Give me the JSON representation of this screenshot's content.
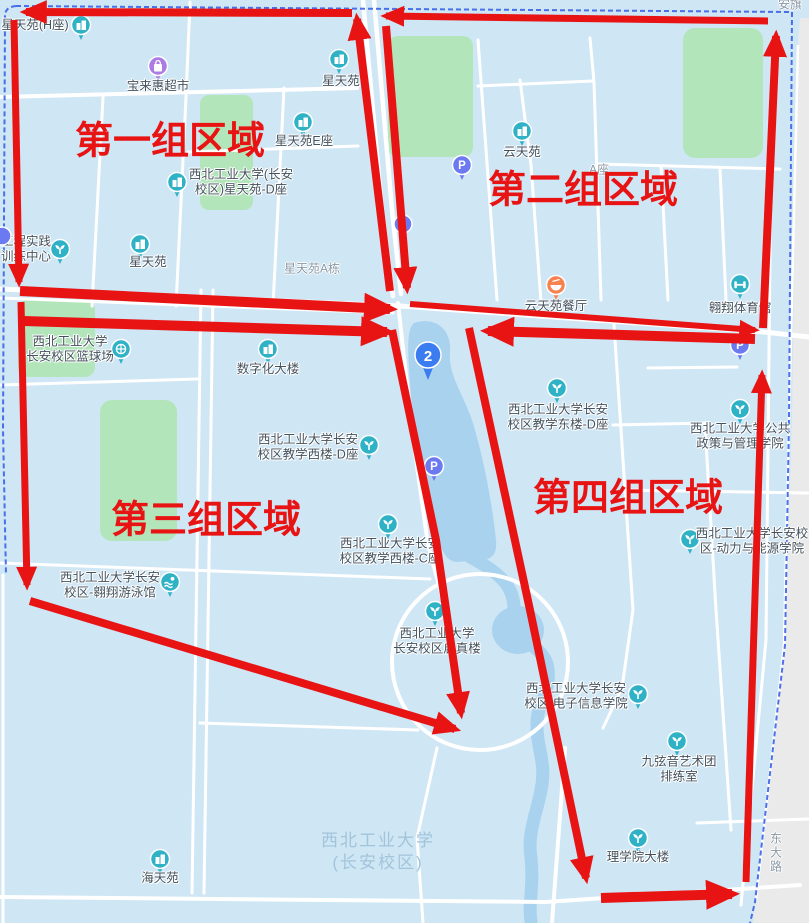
{
  "map_title": "西北工业大学长安校区分组区域图",
  "colors": {
    "red": "#e81414",
    "boundary": "#3a62e8",
    "teal": "#2fb1c6",
    "parking": "#6b7af0",
    "shop": "#ab7ce4",
    "food": "#f8824f",
    "pin": "#3b7cf0",
    "gray_text": "#8a99a6",
    "poi_text": "#44525d",
    "watermark_text": "#a2c4da",
    "water": "#a9d2ee",
    "green": "#b2e6ba",
    "road": "#ffffff",
    "bg": "#cfe6f5"
  },
  "watermark": {
    "line1": "西北工业大学",
    "line2": "(长安校区)",
    "x": 378,
    "y": 852
  },
  "regions": [
    {
      "label": "第一组区域",
      "x": 170,
      "y": 137
    },
    {
      "label": "第二组区域",
      "x": 583,
      "y": 186
    },
    {
      "label": "第三组区域",
      "x": 206,
      "y": 516
    },
    {
      "label": "第四组区域",
      "x": 628,
      "y": 494
    }
  ],
  "street_labels": [
    {
      "text": "星天苑A栋",
      "x": 312,
      "y": 268,
      "vertical": false
    },
    {
      "text": "A座",
      "x": 599,
      "y": 169,
      "vertical": false
    },
    {
      "text": "安旗",
      "x": 790,
      "y": 4,
      "vertical": false
    },
    {
      "text": "东大路",
      "x": 776,
      "y": 853,
      "vertical": true
    }
  ],
  "pois": [
    {
      "icon": "building",
      "ix": 81,
      "iy": 25,
      "lines": [
        "星天苑(H座)"
      ],
      "tx": 35,
      "ty": 25
    },
    {
      "icon": "shop",
      "ix": 158,
      "iy": 66,
      "lines": [
        "宝来惠超市"
      ],
      "tx": 158,
      "ty": 86
    },
    {
      "icon": "building",
      "ix": 339,
      "iy": 59,
      "lines": [
        "星天苑"
      ],
      "tx": 341,
      "ty": 81
    },
    {
      "icon": "building",
      "ix": 303,
      "iy": 122,
      "lines": [
        "星天苑E座"
      ],
      "tx": 304,
      "ty": 141
    },
    {
      "icon": "building",
      "ix": 177,
      "iy": 182,
      "lines": [
        "西北工业大学(长安",
        "校区)星天苑-D座"
      ],
      "tx": 241,
      "ty": 175
    },
    {
      "icon": "plant",
      "ix": 60,
      "iy": 249,
      "lines": [
        "工程实践",
        "训练中心"
      ],
      "tx": 26,
      "ty": 242
    },
    {
      "icon": "building",
      "ix": 140,
      "iy": 244,
      "lines": [
        "星天苑"
      ],
      "tx": 148,
      "ty": 262
    },
    {
      "icon": "building",
      "ix": 522,
      "iy": 131,
      "lines": [
        "云天苑"
      ],
      "tx": 522,
      "ty": 152
    },
    {
      "icon": "p",
      "ix": 462,
      "iy": 165,
      "lines": [],
      "tx": 0,
      "ty": 0
    },
    {
      "icon": "dot",
      "ix": 403,
      "iy": 224,
      "lines": [],
      "tx": 0,
      "ty": 0
    },
    {
      "icon": "dot",
      "ix": 2,
      "iy": 236,
      "lines": [],
      "tx": 0,
      "ty": 0
    },
    {
      "icon": "food",
      "ix": 556,
      "iy": 285,
      "lines": [
        "云天苑餐厅"
      ],
      "tx": 556,
      "ty": 306
    },
    {
      "icon": "gym",
      "ix": 740,
      "iy": 284,
      "lines": [
        "翱翔体育馆"
      ],
      "tx": 740,
      "ty": 308
    },
    {
      "icon": "p",
      "ix": 740,
      "iy": 345,
      "lines": [],
      "tx": 0,
      "ty": 0
    },
    {
      "icon": "basketball",
      "ix": 121,
      "iy": 349,
      "lines": [
        "西北工业大学",
        "长安校区篮球场"
      ],
      "tx": 70,
      "ty": 342
    },
    {
      "icon": "building",
      "ix": 268,
      "iy": 349,
      "lines": [
        "数字化大楼"
      ],
      "tx": 268,
      "ty": 369
    },
    {
      "icon": "pin2",
      "ix": 428,
      "iy": 356,
      "lines": [],
      "tx": 0,
      "ty": 0,
      "badge": "2"
    },
    {
      "icon": "plant",
      "ix": 369,
      "iy": 445,
      "lines": [
        "西北工业大学长安",
        "校区教学西楼-D座"
      ],
      "tx": 308,
      "ty": 440
    },
    {
      "icon": "plant",
      "ix": 557,
      "iy": 388,
      "lines": [
        "西北工业大学长安",
        "校区教学东楼-D座"
      ],
      "tx": 558,
      "ty": 410
    },
    {
      "icon": "plant",
      "ix": 740,
      "iy": 409,
      "lines": [
        "西北工业大学公共",
        "政策与管理学院"
      ],
      "tx": 740,
      "ty": 429
    },
    {
      "icon": "p",
      "ix": 434,
      "iy": 466,
      "lines": [],
      "tx": 0,
      "ty": 0
    },
    {
      "icon": "plant",
      "ix": 388,
      "iy": 524,
      "lines": [
        "西北工业大学长安",
        "校区教学西楼-C座"
      ],
      "tx": 390,
      "ty": 544
    },
    {
      "icon": "plant",
      "ix": 690,
      "iy": 539,
      "lines": [
        "西北工业大学长安校",
        "区-动力与能源学院"
      ],
      "tx": 752,
      "ty": 534
    },
    {
      "icon": "swim",
      "ix": 170,
      "iy": 582,
      "lines": [
        "西北工业大学长安",
        "校区-翱翔游泳馆"
      ],
      "tx": 110,
      "ty": 578
    },
    {
      "icon": "plant",
      "ix": 435,
      "iy": 611,
      "lines": [
        "西北工业大学",
        "长安校区启真楼"
      ],
      "tx": 437,
      "ty": 634
    },
    {
      "icon": "plant",
      "ix": 638,
      "iy": 694,
      "lines": [
        "西北工业大学长安",
        "校区 电子信息学院"
      ],
      "tx": 576,
      "ty": 689
    },
    {
      "icon": "plant",
      "ix": 677,
      "iy": 741,
      "lines": [
        "九弦音艺术团",
        "排练室"
      ],
      "tx": 679,
      "ty": 762
    },
    {
      "icon": "plant",
      "ix": 638,
      "iy": 838,
      "lines": [
        "理学院大楼"
      ],
      "tx": 638,
      "ty": 857
    },
    {
      "icon": "building",
      "ix": 160,
      "iy": 859,
      "lines": [
        "海天苑"
      ],
      "tx": 160,
      "ty": 878
    }
  ],
  "arrows": [
    {
      "pts": [
        [
          352,
          13
        ],
        [
          26,
          12
        ]
      ],
      "w": 8
    },
    {
      "pts": [
        [
          14,
          20
        ],
        [
          19,
          282
        ]
      ],
      "w": 7
    },
    {
      "pts": [
        [
          390,
          291
        ],
        [
          357,
          19
        ]
      ],
      "w": 8
    },
    {
      "pts": [
        [
          768,
          21
        ],
        [
          386,
          16
        ]
      ],
      "w": 7
    },
    {
      "pts": [
        [
          386,
          26
        ],
        [
          407,
          288
        ]
      ],
      "w": 8
    },
    {
      "pts": [
        [
          763,
          328
        ],
        [
          776,
          36
        ]
      ],
      "w": 8
    },
    {
      "pts": [
        [
          20,
          291
        ],
        [
          390,
          309
        ]
      ],
      "w": 10
    },
    {
      "pts": [
        [
          23,
          321
        ],
        [
          387,
          332
        ]
      ],
      "w": 10
    },
    {
      "pts": [
        [
          21,
          302
        ],
        [
          27,
          585
        ]
      ],
      "w": 7
    },
    {
      "pts": [
        [
          30,
          601
        ],
        [
          455,
          729
        ]
      ],
      "w": 8
    },
    {
      "pts": [
        [
          392,
          330
        ],
        [
          436,
          540
        ],
        [
          461,
          713
        ]
      ],
      "w": 8
    },
    {
      "pts": [
        [
          410,
          304
        ],
        [
          755,
          330
        ]
      ],
      "w": 6
    },
    {
      "pts": [
        [
          755,
          339
        ],
        [
          488,
          331
        ]
      ],
      "w": 10
    },
    {
      "pts": [
        [
          469,
          328
        ],
        [
          530,
          610
        ],
        [
          586,
          878
        ]
      ],
      "w": 8
    },
    {
      "pts": [
        [
          601,
          898
        ],
        [
          732,
          894
        ]
      ],
      "w": 10
    },
    {
      "pts": [
        [
          746,
          882
        ],
        [
          762,
          375
        ]
      ],
      "w": 7
    }
  ]
}
